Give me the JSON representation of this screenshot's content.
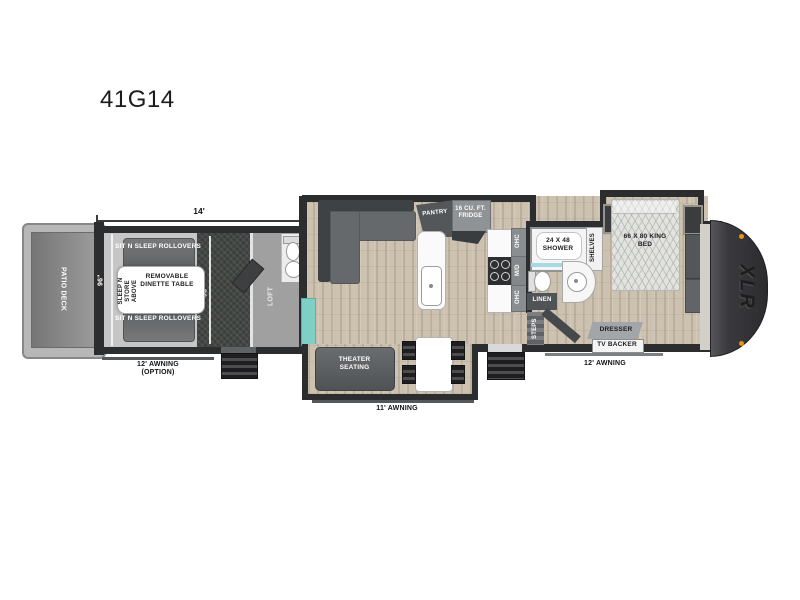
{
  "title": "41G14",
  "colors": {
    "wall": "#2c2d2f",
    "wood_floor": "#cdc1b0",
    "garage_floor": "#c6c6c6",
    "accent_teal": "#7ecfc4",
    "marker_orange": "#e8940f",
    "cap_dark": "#2c2c2f",
    "shower_glass_blue": "#a6d9e0"
  },
  "dimensions": {
    "garage_length": "14'",
    "garage_width_rear": "96\"",
    "garage_width_front": "98\""
  },
  "rear": {
    "patio_deck": "PATIO DECK"
  },
  "garage": {
    "rollover_top": "SIT N SLEEP ROLLOVERS",
    "rollover_bottom": "SIT N SLEEP ROLLOVERS",
    "dinette": "REMOVABLE DINETTE TABLE",
    "sleep_store_line1": "SLEEP N STORE",
    "sleep_store_line2": "ABOVE",
    "awning_label": "12' AWNING",
    "awning_option": "(OPTION)"
  },
  "loft": {
    "label": "LOFT"
  },
  "living": {
    "theater": "THEATER SEATING",
    "awning_label": "11' AWNING",
    "pantry": "PANTRY",
    "fridge": "16 CU. FT. FRIDGE"
  },
  "kitchen": {
    "ohc_top": "OHC",
    "microwave": "M/D",
    "ohc_bottom": "OHC"
  },
  "bath": {
    "shower": "24 X 48 SHOWER",
    "shelves": "SHELVES",
    "linen": "LINEN",
    "steps": "STEPS"
  },
  "bedroom": {
    "bed": "66 X 80 KING BED",
    "ward": "WARD",
    "washer_prep": "WASHER/ DRYER PREP",
    "dresser": "DRESSER",
    "tv_backer": "TV BACKER",
    "awning_label": "12' AWNING"
  },
  "brand": {
    "logo": "XLR"
  }
}
